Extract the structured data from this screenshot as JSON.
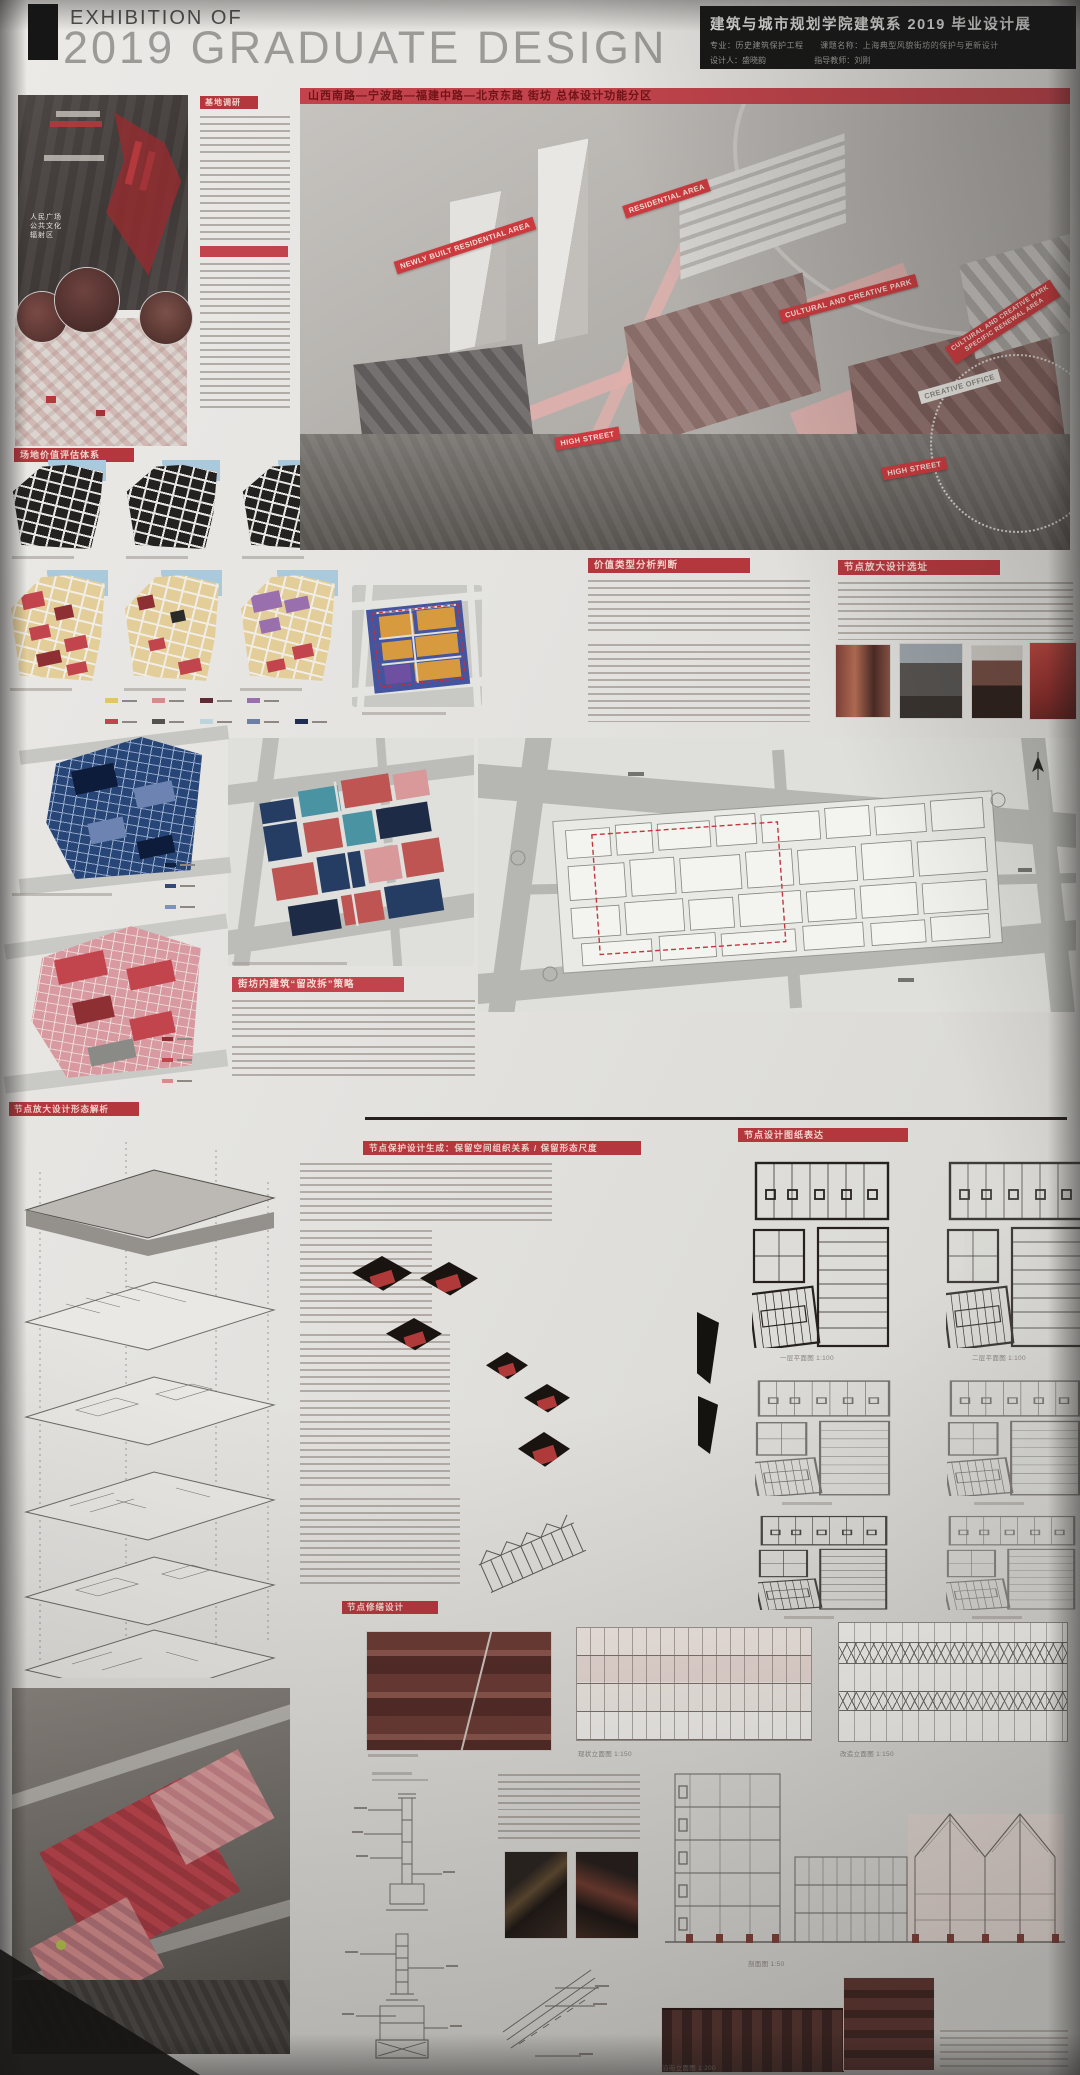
{
  "header": {
    "eyebrow": "EXHIBITION OF",
    "title": "2019 GRADUATE DESIGN"
  },
  "info_box": {
    "title": "建筑与城市规划学院建筑系 2019 毕业设计展",
    "major": "专业：历史建筑保护工程",
    "topic": "课题名称：上海典型风貌街坊的保护与更新设计",
    "designer": "设计人：盛晓韵",
    "advisor": "指导教师：刘刚"
  },
  "section_titles": {
    "site_research": "基地调研",
    "master_plan": "山西南路—宁波路—福建中路—北京东路 街坊 总体设计功能分区",
    "value_system": "场地价值评估体系",
    "value_judgement": "价值类型分析判断",
    "node_site_selection": "节点放大设计选址",
    "building_strategy": "街坊内建筑“留改拆”策略",
    "node_form_analysis": "节点放大设计形态解析",
    "node_generation": "节点保护设计生成：保留空间组织关系 / 保留形态尺度",
    "node_drawings": "节点设计图纸表达",
    "node_repair": "节点修缮设计"
  },
  "master_plan_labels": {
    "newly_built": "NEWLY BUILT RESIDENTIAL AREA",
    "residential": "RESIDENTIAL AREA",
    "cultural_park": "CULTURAL AND CREATIVE PARK",
    "renewal_line1": "CULTURAL AND CREATIVE PARK",
    "renewal_line2": "SPECIFIC RENEWAL AREA",
    "creative_office": "CREATIVE OFFICE",
    "high_street_left": "HIGH STREET",
    "high_street_right": "HIGH STREET"
  },
  "aerial_map": {
    "label_line1": "人民广场",
    "label_line2": "公共文化",
    "label_line3": "辐射区"
  },
  "drawing_captions": {
    "plan_first": "一层平面图 1:100",
    "plan_second": "二层平面图 1:100",
    "elevation_existing": "现状立面图 1:150",
    "elevation_renovated": "改造立面图 1:150",
    "section_detail": "剖面图 1:50",
    "street_elevation": "沿街立面图 1:200"
  },
  "colors": {
    "accent_red": "#b5373e",
    "banner_red": "#cb3a3e",
    "poster_bg": "#e4e3e0",
    "black_panel": "#171717"
  },
  "value_legend": {
    "row1": [
      "#e3c567",
      "#d98a8d",
      "#5e2a33",
      "#9a6fae"
    ],
    "row2": [
      "#c2454e",
      "#55524e",
      "#bcd4da",
      "#6e7fa5",
      "#1f2d52"
    ]
  },
  "quality_legend": [
    "#10203f",
    "#33497a",
    "#7d93bd",
    "#0b1226"
  ],
  "strategy_legend": [
    "#8e2f33",
    "#c2454e",
    "#d98a8d"
  ]
}
